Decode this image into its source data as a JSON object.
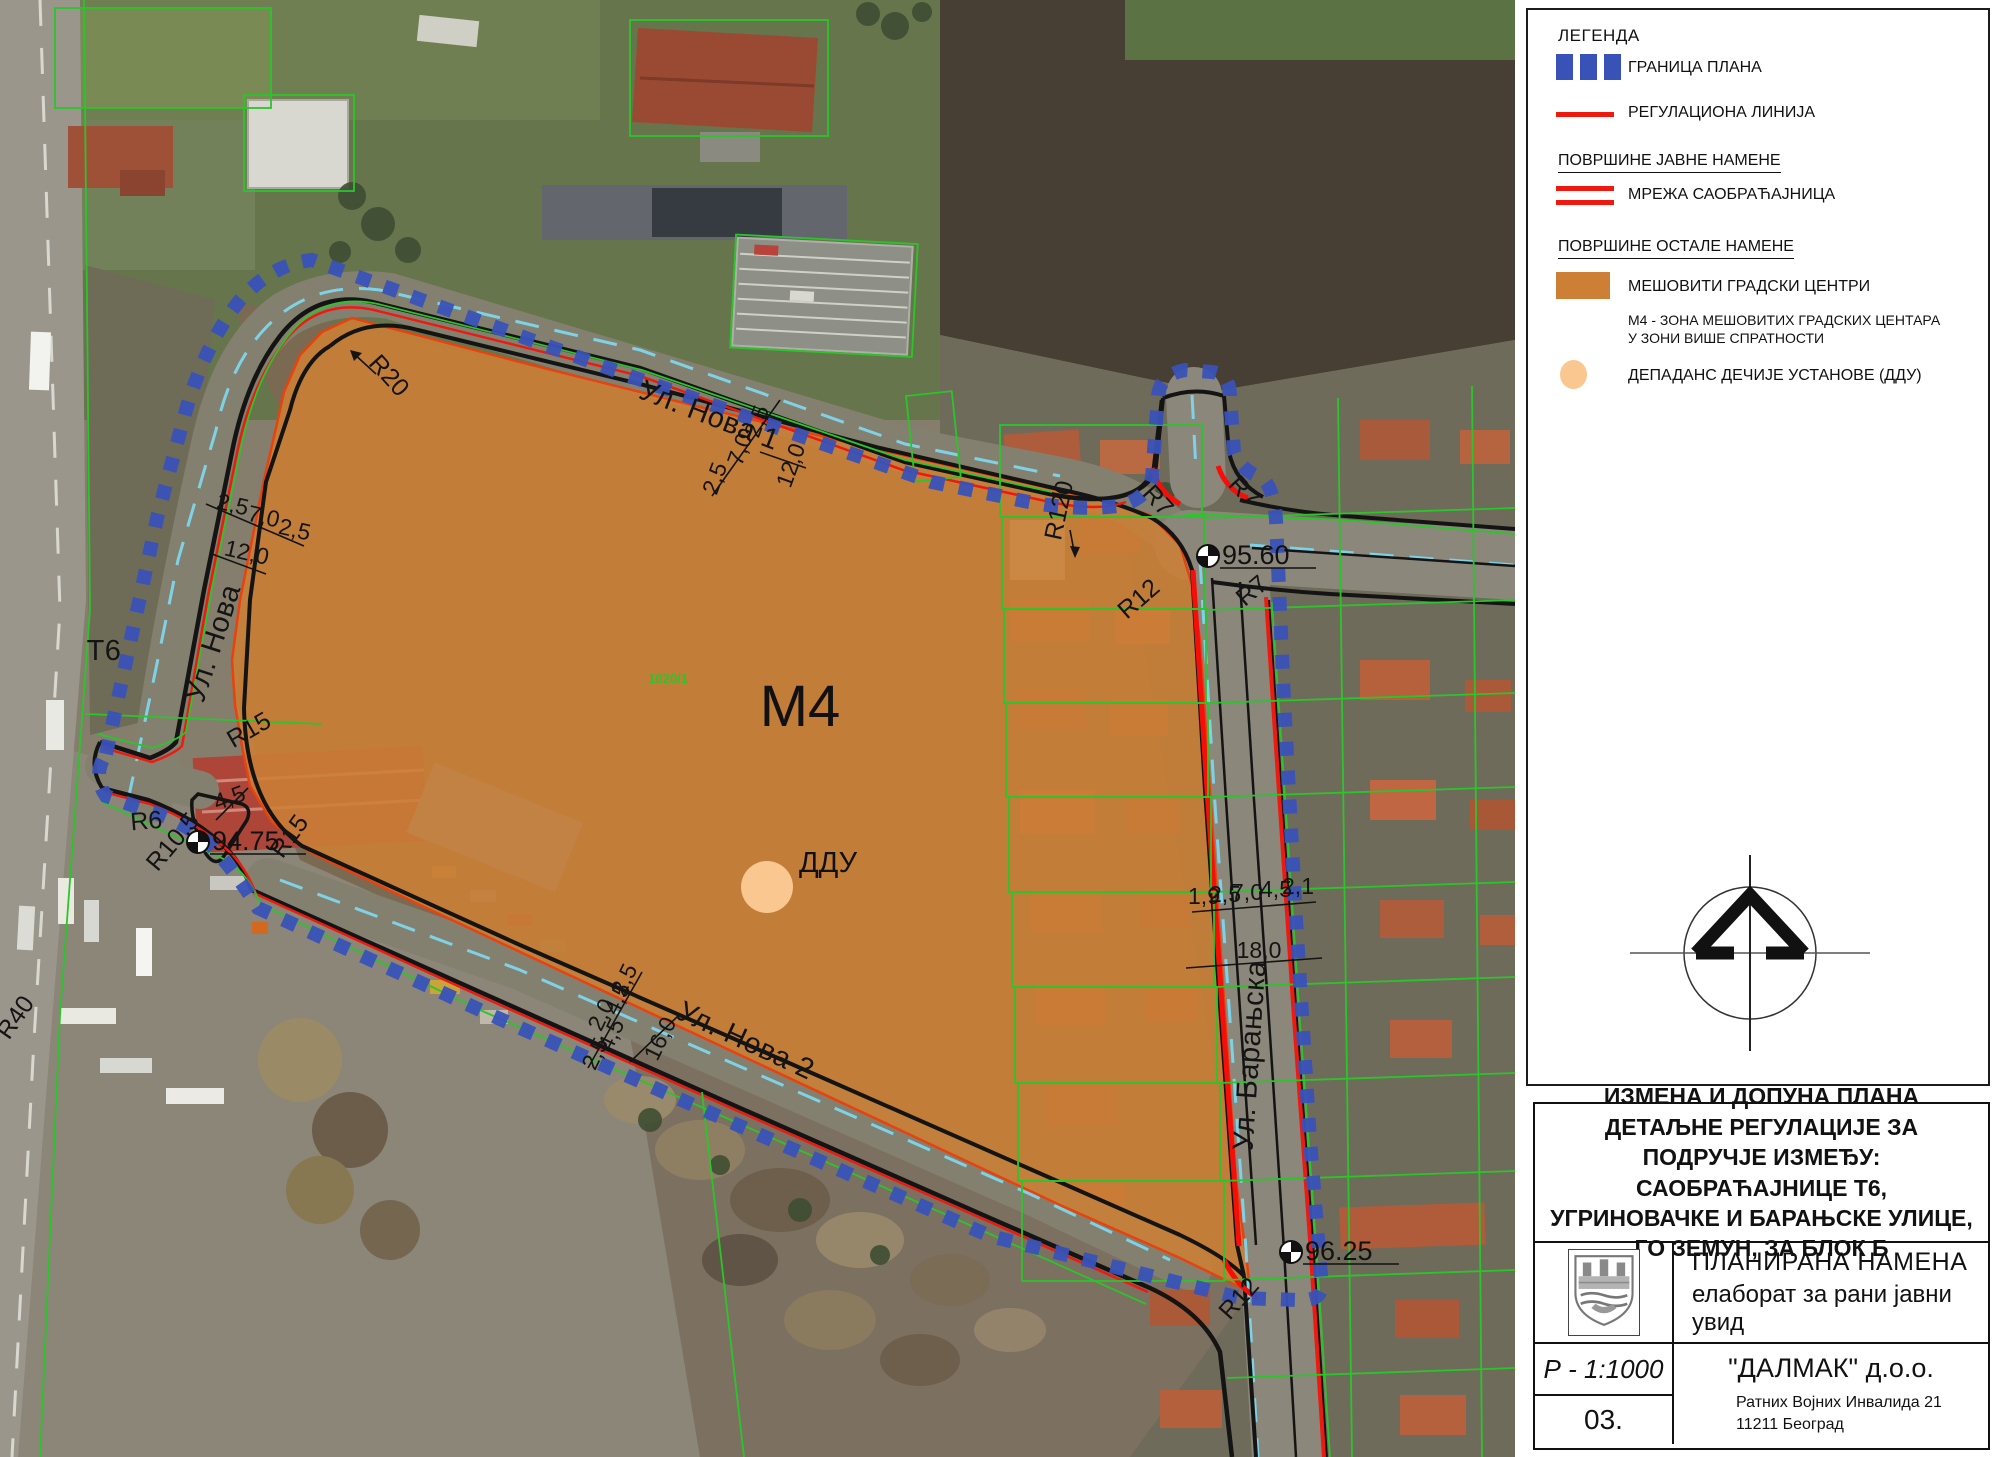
{
  "colors": {
    "plan_boundary_blue": "#3952b8",
    "regulation_red": "#ee1a10",
    "zone_orange": "#cc7f35",
    "ddu_orange": "#f9c78f",
    "road_line_black": "#141414",
    "centerline_cyan": "#7fd2e6",
    "cadastral_green": "#2bc52b"
  },
  "map": {
    "zone_label": {
      "text": "М4",
      "x": 800,
      "y": 726
    },
    "ddu_point": {
      "label": "ДДУ",
      "label_x": 828,
      "label_y": 872,
      "cx": 767,
      "cy": 887,
      "r": 26
    },
    "street_labels": [
      {
        "text": "Ул. Нова",
        "x": 222,
        "y": 646,
        "rot": -72
      },
      {
        "text": "Ул. Нова 1",
        "x": 706,
        "y": 424,
        "rot": 21
      },
      {
        "text": "Ул. Нова 2",
        "x": 742,
        "y": 1049,
        "rot": 25
      },
      {
        "text": "Ул. Барањска",
        "x": 1259,
        "y": 1056,
        "rot": -86
      },
      {
        "text": "Т6",
        "x": 104,
        "y": 660,
        "rot": 0
      }
    ],
    "radius_labels": [
      {
        "text": "R20",
        "x": 383,
        "y": 381,
        "rot": 48
      },
      {
        "text": "R120",
        "x": 1067,
        "y": 512,
        "rot": -78
      },
      {
        "text": "R7",
        "x": 1152,
        "y": 506,
        "rot": 48
      },
      {
        "text": "R7",
        "x": 1238,
        "y": 497,
        "rot": 48
      },
      {
        "text": "R12",
        "x": 1144,
        "y": 605,
        "rot": -41
      },
      {
        "text": "R7",
        "x": 1257,
        "y": 597,
        "rot": -40
      },
      {
        "text": "R15",
        "x": 253,
        "y": 737,
        "rot": -30
      },
      {
        "text": "R15",
        "x": 296,
        "y": 841,
        "rot": -54
      },
      {
        "text": "R6",
        "x": 147,
        "y": 829,
        "rot": -5
      },
      {
        "text": "R10,5",
        "x": 179,
        "y": 847,
        "rot": -50
      },
      {
        "text": "R12",
        "x": 1245,
        "y": 1304,
        "rot": -48
      },
      {
        "text": "R40",
        "x": 22,
        "y": 1022,
        "rot": -55
      }
    ],
    "dimension_labels": [
      {
        "text": "2,5",
        "x": 764,
        "y": 424,
        "rot": -70
      },
      {
        "text": "7,0",
        "x": 747,
        "y": 452,
        "rot": -70
      },
      {
        "text": "2,5",
        "x": 722,
        "y": 481,
        "rot": -70
      },
      {
        "text": "12,0",
        "x": 798,
        "y": 468,
        "rot": -70
      },
      {
        "text": "2,5",
        "x": 231,
        "y": 512,
        "rot": 13
      },
      {
        "text": "7,0",
        "x": 262,
        "y": 524,
        "rot": 13
      },
      {
        "text": "2,5",
        "x": 293,
        "y": 537,
        "rot": 13
      },
      {
        "text": "12,0",
        "x": 245,
        "y": 560,
        "rot": 13
      },
      {
        "text": "2,5",
        "x": 631,
        "y": 983,
        "rot": -64
      },
      {
        "text": "4,5",
        "x": 624,
        "y": 1002,
        "rot": -64
      },
      {
        "text": "2,0",
        "x": 608,
        "y": 1018,
        "rot": -64
      },
      {
        "text": "4,5",
        "x": 618,
        "y": 1038,
        "rot": -64
      },
      {
        "text": "2,5",
        "x": 602,
        "y": 1057,
        "rot": -64
      },
      {
        "text": "16,0",
        "x": 667,
        "y": 1042,
        "rot": -64
      },
      {
        "text": "4,5",
        "x": 232,
        "y": 805,
        "rot": -20
      },
      {
        "text": "1,9",
        "x": 1204,
        "y": 904,
        "rot": 0
      },
      {
        "text": "2,5",
        "x": 1225,
        "y": 902,
        "rot": 0
      },
      {
        "text": "7,0",
        "x": 1247,
        "y": 900,
        "rot": 0
      },
      {
        "text": "4,5",
        "x": 1276,
        "y": 897,
        "rot": 0
      },
      {
        "text": "2,1",
        "x": 1298,
        "y": 894,
        "rot": 0
      },
      {
        "text": "18,0",
        "x": 1259,
        "y": 958,
        "rot": 0
      }
    ],
    "elevation_markers": [
      {
        "value": "94.75",
        "x": 198,
        "y": 842
      },
      {
        "value": "95.60",
        "x": 1208,
        "y": 556
      },
      {
        "value": "96.25",
        "x": 1291,
        "y": 1252
      }
    ],
    "parcel_labels": [
      {
        "text": "1020/1",
        "x": 668,
        "y": 683
      }
    ]
  },
  "legend": {
    "title": "ЛЕГЕНДА",
    "items": [
      {
        "id": "plan-boundary",
        "label": "ГРАНИЦА ПЛАНА"
      },
      {
        "id": "regulation-line",
        "label": "РЕГУЛАЦИОНА ЛИНИЈА"
      },
      {
        "id": "public-heading",
        "label": "ПОВРШИНЕ ЈАВНЕ НАМЕНЕ"
      },
      {
        "id": "road-network",
        "label": "МРЕЖА САОБРАЋАЈНИЦА"
      },
      {
        "id": "other-heading",
        "label": "ПОВРШИНЕ ОСТАЛЕ НАМЕНЕ"
      },
      {
        "id": "mixed-centers",
        "label": "МЕШОВИТИ ГРАДСКИ ЦЕНТРИ",
        "sub1": "М4 - ЗОНА МЕШОВИТИХ ГРАДСКИХ ЦЕНТАРА",
        "sub2": "У ЗОНИ ВИШЕ СПРАТНОСТИ"
      },
      {
        "id": "ddu",
        "label": "ДЕПАДАНС ДЕЧИЈЕ УСТАНОВЕ (ДДУ)"
      }
    ]
  },
  "title_block": {
    "title": "ИЗМЕНА И ДОПУНА ПЛАНА ДЕТАЉНЕ РЕГУЛАЦИЈЕ ЗА ПОДРУЧЈЕ ИЗМЕЂУ: САОБРАЋАЈНИЦЕ Т6, УГРИНОВАЧКЕ И БАРАЊСКЕ УЛИЦЕ, ГО ЗЕМУН, ЗА БЛОК Б",
    "drawing_name": "ПЛАНИРАНА НАМЕНА",
    "drawing_subtitle": "елаборат за рани јавни увид",
    "scale": "Р - 1:1000",
    "sheet_number": "03.",
    "company": "\"ДАЛМАК\" д.о.о.",
    "address_line1": "Ратних Војних Инвалида 21",
    "address_line2": "11211 Београд"
  }
}
